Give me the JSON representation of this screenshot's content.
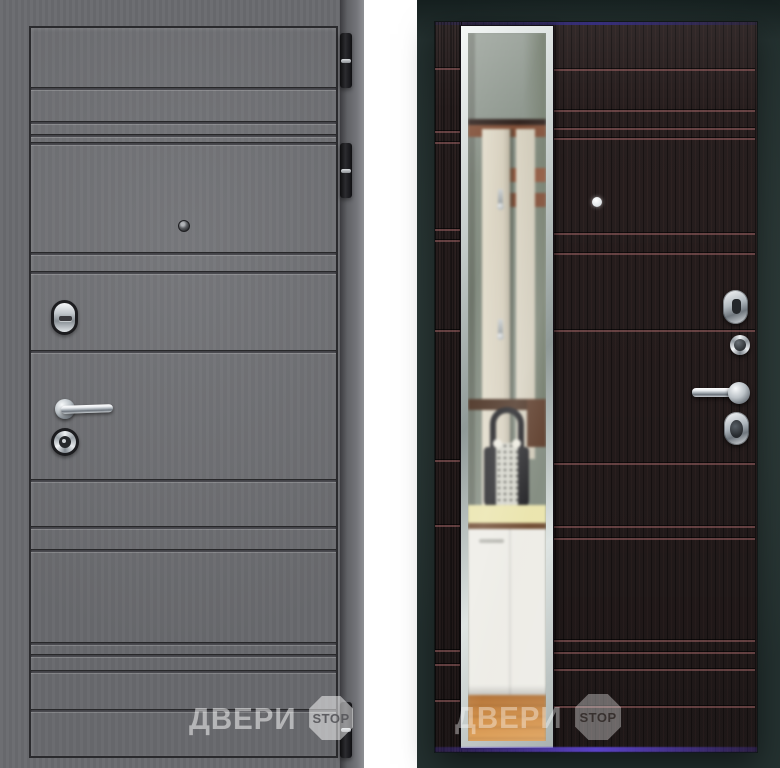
{
  "watermarks": {
    "brand_text": "ДВЕРИ",
    "stop_text": "STOP"
  },
  "palette": {
    "page_bg": "#ffffff",
    "left_casing": "#6a6b6f",
    "left_panel": "#707175",
    "hinge_black": "#1b1b1e",
    "right_bg": "#2e3c3a",
    "wenge": "#271e1e",
    "groove_red": "#9e6164",
    "mirror_bevel": "#dfe5e3",
    "glow_purple": "#5a43c8",
    "chrome": "#d7dcdf"
  },
  "left_door": {
    "groove_lines_y": [
      85,
      119,
      132,
      140,
      250,
      269,
      348,
      477,
      524,
      547,
      640,
      652,
      668,
      707
    ],
    "hinges": [
      {
        "y": 33,
        "h": 55
      },
      {
        "y": 143,
        "h": 55
      },
      {
        "y": 702,
        "h": 56
      }
    ],
    "hardware": [
      "peephole",
      "night-latch-escutcheon",
      "lever-handle",
      "cylinder-lock"
    ]
  },
  "right_door": {
    "panel_groove_lines_y": [
      69,
      110,
      128,
      138,
      233,
      253,
      330,
      463,
      526,
      538,
      640,
      652,
      669,
      706
    ],
    "stile_groove_lines_y": [
      68,
      131,
      142,
      229,
      240,
      330,
      460,
      525,
      650,
      664,
      700
    ],
    "hardware": [
      "peephole",
      "escutcheon",
      "cylinder-lock",
      "lever-handle",
      "oval-cylinder-lock"
    ]
  }
}
